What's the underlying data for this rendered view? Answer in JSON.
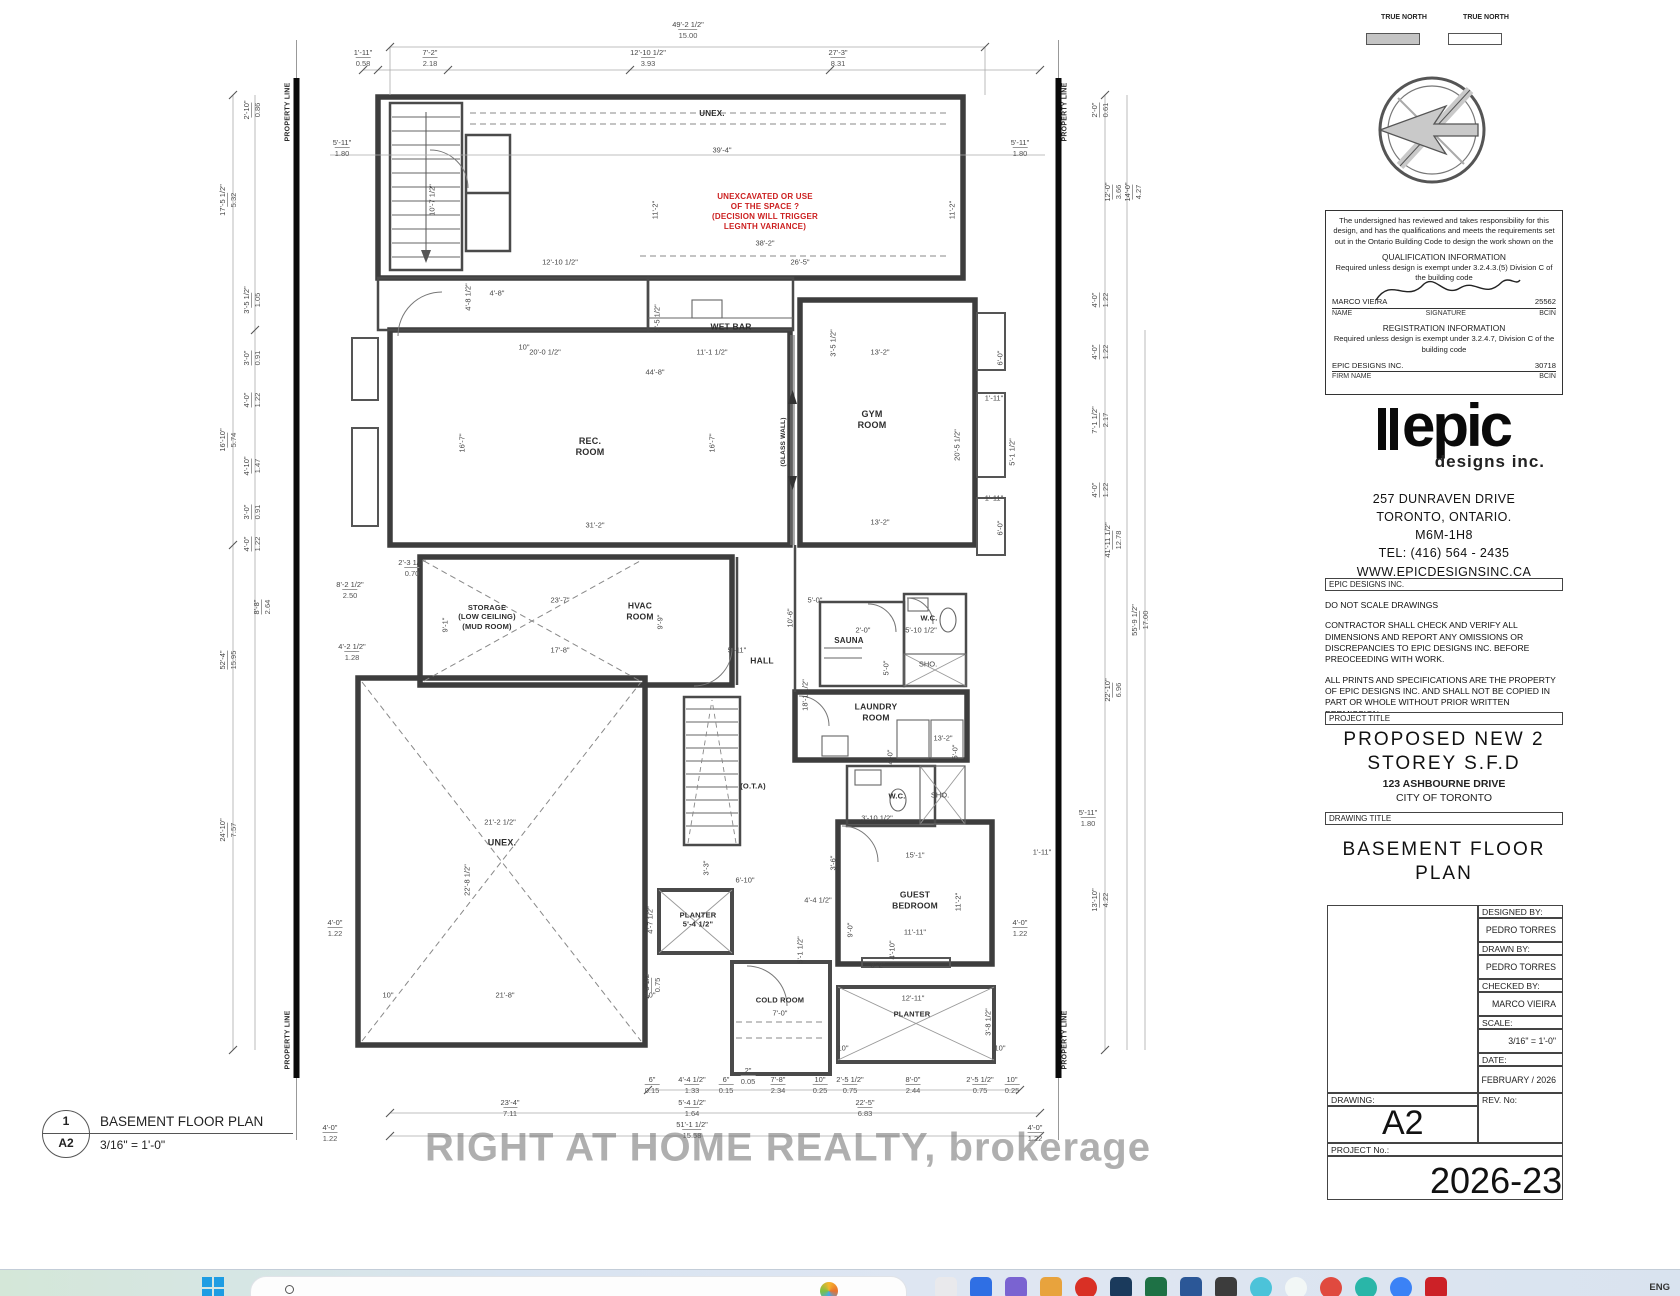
{
  "north": {
    "left_label": "TRUE\nNORTH",
    "right_label": "TRUE\nNORTH"
  },
  "qualification": {
    "intro": "The undersigned has reviewed and takes responsibility for this design, and has the qualifications and meets the requirements set out in the Ontario Building Code to design the work shown on the",
    "qual_header": "QUALIFICATION INFORMATION",
    "qual_req": "Required unless design is exempt under 3.2.4.3.(5) Division C of the building code",
    "name_value": "MARCO VIEIRA",
    "name_label": "NAME",
    "signature_label": "SIGNATURE",
    "bcin_value": "25562",
    "bcin_label": "BCIN",
    "reg_header": "REGISTRATION INFORMATION",
    "reg_req": "Required unless design is exempt under 3.2.4.7, Division C of the building code",
    "firm_value": "EPIC DESIGNS INC.",
    "firm_label": "FIRM NAME",
    "firm_bcin_value": "30718",
    "firm_bcin_label": "BCIN"
  },
  "company": {
    "logo_text": "epic",
    "logo_sub": "designs inc.",
    "address1": "257 DUNRAVEN DRIVE",
    "address2": "TORONTO, ONTARIO.",
    "postal": "M6M-1H8",
    "tel": "TEL: (416)  564 - 2435",
    "web": "WWW.EPICDESIGNSINC.CA"
  },
  "notes": {
    "header": "EPIC DESIGNS INC.",
    "note1": "DO NOT SCALE DRAWINGS",
    "note2": "CONTRACTOR SHALL CHECK AND VERIFY ALL DIMENSIONS AND REPORT ANY OMISSIONS OR DISCREPANCIES TO EPIC DESIGNS INC. BEFORE PREOCEEDING WITH WORK.",
    "note3": "ALL PRINTS AND SPECIFICATIONS ARE THE PROPERTY OF EPIC DESIGNS INC. AND SHALL NOT BE COPIED IN PART OR WHOLE WITHOUT PRIOR WRITTEN PERMISSION."
  },
  "project": {
    "label": "PROJECT TITLE",
    "title": "PROPOSED NEW 2\nSTOREY S.F.D",
    "address": "123 ASHBOURNE DRIVE",
    "city": "CITY OF TORONTO"
  },
  "drawing": {
    "label": "DRAWING TITLE",
    "title": "BASEMENT FLOOR\nPLAN",
    "designed_by_label": "DESIGNED BY:",
    "designed_by": "PEDRO TORRES",
    "drawn_by_label": "DRAWN BY:",
    "drawn_by": "PEDRO TORRES",
    "checked_by_label": "CHECKED BY:",
    "checked_by": "MARCO VIEIRA",
    "scale_label": "SCALE:",
    "scale": "3/16\" = 1'-0\"",
    "date_label": "DATE:",
    "date": "FEBRUARY / 2026",
    "drawing_label": "DRAWING:",
    "drawing_no": "A2",
    "rev_label": "REV. No:",
    "project_no_label": "PROJECT No.:",
    "project_no": "2026-23"
  },
  "watermark": "RIGHT AT HOME REALTY, brokerage",
  "taskbar": {
    "language": "ENG",
    "icons": [
      {
        "name": "app-icon-1",
        "color": "#e9e9ec",
        "shape": "square"
      },
      {
        "name": "app-icon-2",
        "color": "#2f6fe4",
        "shape": "square"
      },
      {
        "name": "app-icon-3",
        "color": "#7a63d1",
        "shape": "square"
      },
      {
        "name": "app-icon-4",
        "color": "#e8a33d",
        "shape": "square"
      },
      {
        "name": "app-icon-5",
        "color": "#d93025",
        "shape": "circle"
      },
      {
        "name": "app-icon-6",
        "color": "#1a3a5c",
        "shape": "square"
      },
      {
        "name": "app-icon-7",
        "color": "#1e7145",
        "shape": "square"
      },
      {
        "name": "app-icon-8",
        "color": "#2b5797",
        "shape": "square"
      },
      {
        "name": "app-icon-9",
        "color": "#3c3c3c",
        "shape": "square"
      },
      {
        "name": "app-icon-10",
        "color": "#4cc3d9",
        "shape": "circle"
      },
      {
        "name": "app-icon-11",
        "color": "#f2f7f6",
        "shape": "circle"
      },
      {
        "name": "app-icon-12",
        "color": "#e04a3f",
        "shape": "circle"
      },
      {
        "name": "app-icon-13",
        "color": "#29b6a8",
        "shape": "circle"
      },
      {
        "name": "app-icon-14",
        "color": "#3b82f6",
        "shape": "circle"
      },
      {
        "name": "app-icon-15",
        "color": "#cc2127",
        "shape": "square"
      }
    ]
  },
  "plan": {
    "callout": {
      "number": "1",
      "sheet": "A2",
      "title": "BASEMENT FLOOR PLAN",
      "scale": "3/16\" = 1'-0\""
    },
    "rooms": [
      {
        "n": "property-line-label",
        "l": "PROPERTY LINE",
        "x": 289,
        "y": 112,
        "sz": 7,
        "r": -90
      },
      {
        "n": "property-line-label",
        "l": "PROPERTY LINE",
        "x": 289,
        "y": 1040,
        "sz": 7,
        "r": -90
      },
      {
        "n": "property-line-label",
        "l": "PROPERTY LINE",
        "x": 1066,
        "y": 112,
        "sz": 7,
        "r": -90
      },
      {
        "n": "property-line-label",
        "l": "PROPERTY LINE",
        "x": 1066,
        "y": 1040,
        "sz": 7,
        "r": -90
      },
      {
        "n": "room-label-unex-top",
        "l": "UNEX.",
        "x": 712,
        "y": 114,
        "sz": 8
      },
      {
        "n": "unexcavated-note",
        "l": "UNEXCAVATED OR USE\nOF THE SPACE ?\n(DECISION WILL TRIGGER\nLEGNTH VARIANCE)",
        "x": 765,
        "y": 212,
        "sz": 8,
        "c": "#cc1f1f"
      },
      {
        "n": "room-label-wet-bar",
        "l": "WET BAR",
        "x": 731,
        "y": 327,
        "sz": 8.5
      },
      {
        "n": "room-label-rec-room",
        "l": "REC.\nROOM",
        "x": 590,
        "y": 447,
        "sz": 9
      },
      {
        "n": "room-label-gym-room",
        "l": "GYM\nROOM",
        "x": 872,
        "y": 420,
        "sz": 9
      },
      {
        "n": "glass-wall-note",
        "l": "(GLASS WALL)",
        "x": 784,
        "y": 442,
        "sz": 6.5,
        "r": -90
      },
      {
        "n": "room-label-storage",
        "l": "STORAGE\n(LOW CEILING)\n(MUD ROOM)",
        "x": 487,
        "y": 617,
        "sz": 7.5
      },
      {
        "n": "room-label-hvac",
        "l": "HVAC\nROOM",
        "x": 640,
        "y": 611,
        "sz": 8.5
      },
      {
        "n": "room-label-hall",
        "l": "HALL",
        "x": 762,
        "y": 661,
        "sz": 8.5
      },
      {
        "n": "room-label-sauna",
        "l": "SAUNA",
        "x": 849,
        "y": 641,
        "sz": 8
      },
      {
        "n": "room-label-wc-1",
        "l": "W.C.",
        "x": 929,
        "y": 618,
        "sz": 7.5
      },
      {
        "n": "room-label-laundry",
        "l": "LAUNDRY\nROOM",
        "x": 876,
        "y": 712,
        "sz": 8.5
      },
      {
        "n": "room-label-wc-2",
        "l": "W.C.",
        "x": 897,
        "y": 796,
        "sz": 7.5
      },
      {
        "n": "room-label-ota",
        "l": "(O.T.A)",
        "x": 753,
        "y": 786,
        "sz": 7.5
      },
      {
        "n": "room-label-unex-main",
        "l": "UNEX.",
        "x": 502,
        "y": 843,
        "sz": 9
      },
      {
        "n": "room-label-planter-mid",
        "l": "PLANTER\n5'-4 1/2\"",
        "x": 698,
        "y": 920,
        "sz": 7.5
      },
      {
        "n": "room-label-guest-bedroom",
        "l": "GUEST\nBEDROOM",
        "x": 915,
        "y": 900,
        "sz": 8.5
      },
      {
        "n": "room-label-cold-room",
        "l": "COLD ROOM",
        "x": 780,
        "y": 1000,
        "sz": 7.5
      },
      {
        "n": "room-label-planter-bottom",
        "l": "PLANTER",
        "x": 912,
        "y": 1014,
        "sz": 7.5
      }
    ],
    "dims": [
      {
        "x": 688,
        "y": 30,
        "t": "49'-2 1/2\"",
        "s": "15.00"
      },
      {
        "x": 363,
        "y": 58,
        "t": "1'-11\"",
        "s": "0.58"
      },
      {
        "x": 430,
        "y": 58,
        "t": "7'-2\"",
        "s": "2.18"
      },
      {
        "x": 648,
        "y": 58,
        "t": "12'-10 1/2\"",
        "s": "3.93"
      },
      {
        "x": 838,
        "y": 58,
        "t": "27'-3\"",
        "s": "8.31"
      },
      {
        "x": 342,
        "y": 148,
        "t": "5'-11\"",
        "s": "1.80"
      },
      {
        "x": 722,
        "y": 150,
        "t": "39'-4\""
      },
      {
        "x": 1020,
        "y": 148,
        "t": "5'-11\"",
        "s": "1.80"
      },
      {
        "x": 655,
        "y": 210,
        "t": "11'-2\"",
        "r": -90
      },
      {
        "x": 952,
        "y": 210,
        "t": "11'-2\"",
        "r": -90
      },
      {
        "x": 765,
        "y": 243,
        "t": "38'-2\""
      },
      {
        "x": 560,
        "y": 262,
        "t": "12'-10 1/2\""
      },
      {
        "x": 800,
        "y": 262,
        "t": "26'-5\""
      },
      {
        "x": 432,
        "y": 200,
        "t": "10'-7 1/2\"",
        "r": -90
      },
      {
        "x": 468,
        "y": 297,
        "t": "4'-8 1/2\"",
        "r": -90
      },
      {
        "x": 497,
        "y": 293,
        "t": "4'-8\""
      },
      {
        "x": 524,
        "y": 347,
        "t": "10\""
      },
      {
        "x": 657,
        "y": 318,
        "t": "3'-5 1/2\"",
        "r": -90
      },
      {
        "x": 833,
        "y": 343,
        "t": "3'-5 1/2\"",
        "r": -90
      },
      {
        "x": 252,
        "y": 110,
        "t": "2'-10\"",
        "s": "0.86",
        "r": -90
      },
      {
        "x": 228,
        "y": 200,
        "t": "17'-5 1/2\"",
        "s": "5.32",
        "r": -90
      },
      {
        "x": 252,
        "y": 300,
        "t": "3'-5 1/2\"",
        "s": "1.05",
        "r": -90
      },
      {
        "x": 252,
        "y": 358,
        "t": "3'-0\"",
        "s": "0.91",
        "r": -90
      },
      {
        "x": 252,
        "y": 400,
        "t": "4'-0\"",
        "s": "1.22",
        "r": -90
      },
      {
        "x": 228,
        "y": 440,
        "t": "16'-10\"",
        "s": "5.74",
        "r": -90
      },
      {
        "x": 252,
        "y": 466,
        "t": "4'-10\"",
        "s": "1.47",
        "r": -90
      },
      {
        "x": 252,
        "y": 512,
        "t": "3'-0\"",
        "s": "0.91",
        "r": -90
      },
      {
        "x": 252,
        "y": 544,
        "t": "4'-0\"",
        "s": "1.22",
        "r": -90
      },
      {
        "x": 228,
        "y": 660,
        "t": "52'-4\"",
        "s": "15.95",
        "r": -90
      },
      {
        "x": 350,
        "y": 590,
        "t": "8'-2 1/2\"",
        "s": "2.50"
      },
      {
        "x": 262,
        "y": 607,
        "t": "8'-8\"",
        "s": "2.64",
        "r": -90
      },
      {
        "x": 228,
        "y": 830,
        "t": "24'-10\"",
        "s": "7.57",
        "r": -90
      },
      {
        "x": 335,
        "y": 928,
        "t": "4'-0\"",
        "s": "1.22"
      },
      {
        "x": 352,
        "y": 652,
        "t": "4'-2 1/2\"",
        "s": "1.28"
      },
      {
        "x": 1100,
        "y": 110,
        "t": "2'-0\"",
        "s": "0.61",
        "r": -90
      },
      {
        "x": 1113,
        "y": 192,
        "t": "12'-0\"",
        "s": "3.66",
        "r": -90
      },
      {
        "x": 1133,
        "y": 192,
        "t": "14'-0\"",
        "s": "4.27",
        "r": -90
      },
      {
        "x": 1100,
        "y": 300,
        "t": "4'-0\"",
        "s": "1.22",
        "r": -90
      },
      {
        "x": 1100,
        "y": 352,
        "t": "4'-0\"",
        "s": "1.22",
        "r": -90
      },
      {
        "x": 1100,
        "y": 420,
        "t": "7'-1 1/2\"",
        "s": "2.17",
        "r": -90
      },
      {
        "x": 1100,
        "y": 490,
        "t": "4'-0\"",
        "s": "1.22",
        "r": -90
      },
      {
        "x": 1113,
        "y": 540,
        "t": "41'-11 1/2\"",
        "s": "12.78",
        "r": -90
      },
      {
        "x": 1140,
        "y": 620,
        "t": "55'-9 1/2\"",
        "s": "17.00",
        "r": -90
      },
      {
        "x": 1113,
        "y": 690,
        "t": "22'-10\"",
        "s": "6.96",
        "r": -90
      },
      {
        "x": 1100,
        "y": 900,
        "t": "13'-10\"",
        "s": "4.22",
        "r": -90
      },
      {
        "x": 1020,
        "y": 928,
        "t": "4'-0\"",
        "s": "1.22"
      },
      {
        "x": 1000,
        "y": 358,
        "t": "6'-0\"",
        "r": -90
      },
      {
        "x": 994,
        "y": 398,
        "t": "1'-11\""
      },
      {
        "x": 1012,
        "y": 452,
        "t": "5'-1 1/2\"",
        "r": -90
      },
      {
        "x": 1000,
        "y": 528,
        "t": "6'-0\"",
        "r": -90
      },
      {
        "x": 994,
        "y": 498,
        "t": "1'-11\""
      },
      {
        "x": 545,
        "y": 352,
        "t": "20'-0 1/2\""
      },
      {
        "x": 712,
        "y": 352,
        "t": "11'-1 1/2\""
      },
      {
        "x": 655,
        "y": 372,
        "t": "44'-8\""
      },
      {
        "x": 462,
        "y": 443,
        "t": "16'-7\"",
        "r": -90
      },
      {
        "x": 712,
        "y": 443,
        "t": "16'-7\"",
        "r": -90
      },
      {
        "x": 595,
        "y": 525,
        "t": "31'-2\""
      },
      {
        "x": 880,
        "y": 352,
        "t": "13'-2\""
      },
      {
        "x": 880,
        "y": 522,
        "t": "13'-2\""
      },
      {
        "x": 957,
        "y": 445,
        "t": "20'-5 1/2\"",
        "r": -90
      },
      {
        "x": 412,
        "y": 568,
        "t": "2'-3 1/2\"",
        "s": "0.70"
      },
      {
        "x": 560,
        "y": 600,
        "t": "23'-7\""
      },
      {
        "x": 445,
        "y": 625,
        "t": "9'-1\"",
        "r": -90
      },
      {
        "x": 560,
        "y": 650,
        "t": "17'-8\""
      },
      {
        "x": 660,
        "y": 622,
        "t": "9'-9\"",
        "r": -90
      },
      {
        "x": 737,
        "y": 650,
        "t": "5'-11\""
      },
      {
        "x": 815,
        "y": 600,
        "t": "5'-0\""
      },
      {
        "x": 790,
        "y": 618,
        "t": "10'-6\"",
        "r": -90
      },
      {
        "x": 863,
        "y": 630,
        "t": "2'-0\""
      },
      {
        "x": 921,
        "y": 630,
        "t": "5'-10 1/2\""
      },
      {
        "x": 928,
        "y": 664,
        "t": "SHO."
      },
      {
        "x": 886,
        "y": 668,
        "t": "5'-0\"",
        "r": -90
      },
      {
        "x": 805,
        "y": 695,
        "t": "18'-1 1/2\"",
        "r": -90
      },
      {
        "x": 943,
        "y": 738,
        "t": "13'-2\""
      },
      {
        "x": 890,
        "y": 757,
        "t": "4'-0\"",
        "r": -90
      },
      {
        "x": 955,
        "y": 752,
        "t": "5'-0\"",
        "r": -90
      },
      {
        "x": 877,
        "y": 818,
        "t": "3'-10 1/2\""
      },
      {
        "x": 1088,
        "y": 818,
        "t": "5'-11\"",
        "s": "1.80"
      },
      {
        "x": 940,
        "y": 795,
        "t": "SHO."
      },
      {
        "x": 500,
        "y": 822,
        "t": "21'-2 1/2\""
      },
      {
        "x": 467,
        "y": 880,
        "t": "22'-8 1/2\"",
        "r": -90
      },
      {
        "x": 505,
        "y": 995,
        "t": "21'-8\""
      },
      {
        "x": 388,
        "y": 995,
        "t": "10\""
      },
      {
        "x": 650,
        "y": 995,
        "t": "10\""
      },
      {
        "x": 706,
        "y": 868,
        "t": "3'-3\"",
        "r": -90
      },
      {
        "x": 745,
        "y": 880,
        "t": "6'-10\""
      },
      {
        "x": 650,
        "y": 920,
        "t": "4'-7 1/2\"",
        "r": -90
      },
      {
        "x": 652,
        "y": 985,
        "t": "2'-5 1/2\"",
        "s": "0.75",
        "r": -90
      },
      {
        "x": 800,
        "y": 950,
        "t": "5'-1 1/2\"",
        "r": -90
      },
      {
        "x": 833,
        "y": 863,
        "t": "3'-6\"",
        "r": -90
      },
      {
        "x": 818,
        "y": 900,
        "t": "4'-4 1/2\""
      },
      {
        "x": 850,
        "y": 930,
        "t": "9'-0\"",
        "r": -90
      },
      {
        "x": 892,
        "y": 950,
        "t": "4'-10\"",
        "r": -90
      },
      {
        "x": 878,
        "y": 965,
        "t": "3'-2\""
      },
      {
        "x": 915,
        "y": 855,
        "t": "15'-1\""
      },
      {
        "x": 958,
        "y": 902,
        "t": "11'-2\"",
        "r": -90
      },
      {
        "x": 915,
        "y": 932,
        "t": "11'-11\""
      },
      {
        "x": 1042,
        "y": 852,
        "t": "1'-11\""
      },
      {
        "x": 913,
        "y": 998,
        "t": "12'-11\""
      },
      {
        "x": 988,
        "y": 1022,
        "t": "3'-8 1/2\"",
        "r": -90
      },
      {
        "x": 780,
        "y": 1013,
        "t": "7'-0\""
      },
      {
        "x": 843,
        "y": 1048,
        "t": "10\""
      },
      {
        "x": 1000,
        "y": 1048,
        "t": "10\""
      },
      {
        "x": 652,
        "y": 1085,
        "t": "6\"",
        "s": "0.15"
      },
      {
        "x": 692,
        "y": 1085,
        "t": "4'-4 1/2\"",
        "s": "1.33"
      },
      {
        "x": 726,
        "y": 1085,
        "t": "6\"",
        "s": "0.15"
      },
      {
        "x": 748,
        "y": 1076,
        "t": "2\"",
        "s": "0.05"
      },
      {
        "x": 778,
        "y": 1085,
        "t": "7'-8\"",
        "s": "2.34"
      },
      {
        "x": 820,
        "y": 1085,
        "t": "10\"",
        "s": "0.25"
      },
      {
        "x": 850,
        "y": 1085,
        "t": "2'-5 1/2\"",
        "s": "0.75"
      },
      {
        "x": 913,
        "y": 1085,
        "t": "8'-0\"",
        "s": "2.44"
      },
      {
        "x": 980,
        "y": 1085,
        "t": "2'-5 1/2\"",
        "s": "0.75"
      },
      {
        "x": 1012,
        "y": 1085,
        "t": "10\"",
        "s": "0.25"
      },
      {
        "x": 510,
        "y": 1108,
        "t": "23'-4\"",
        "s": "7.11"
      },
      {
        "x": 692,
        "y": 1108,
        "t": "5'-4 1/2\"",
        "s": "1.64"
      },
      {
        "x": 865,
        "y": 1108,
        "t": "22'-5\"",
        "s": "6.83"
      },
      {
        "x": 692,
        "y": 1130,
        "t": "51'-1 1/2\"",
        "s": "15.58"
      },
      {
        "x": 330,
        "y": 1133,
        "t": "4'-0\"",
        "s": "1.22"
      },
      {
        "x": 1035,
        "y": 1133,
        "t": "4'-0\"",
        "s": "1.22"
      }
    ]
  }
}
